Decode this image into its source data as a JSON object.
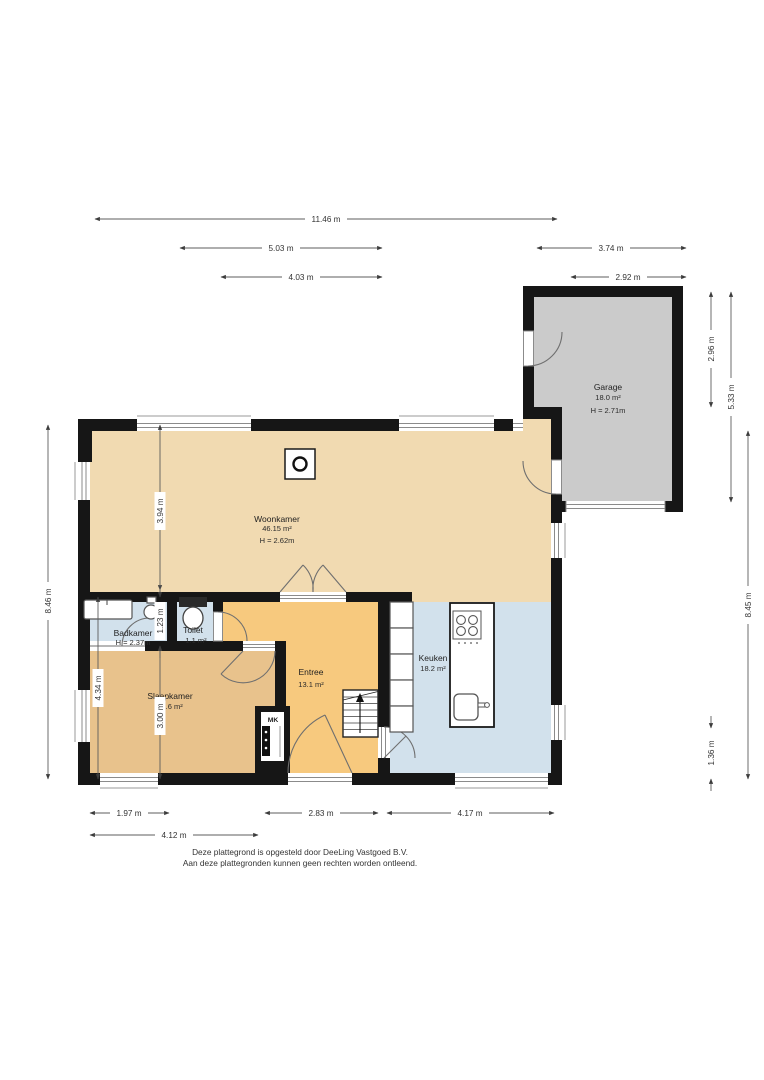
{
  "rooms": {
    "woonkamer": {
      "name": "Woonkamer",
      "area": "46.15 m²",
      "height": "H = 2.62m"
    },
    "garage": {
      "name": "Garage",
      "area": "18.0 m²",
      "height": "H = 2.71m"
    },
    "badkamer": {
      "name": "Badkamer",
      "height": "H = 2.37m"
    },
    "toilet": {
      "name": "Toilet",
      "area": "1.1 m²"
    },
    "slaapkamer": {
      "name": "Slaapkamer",
      "area": "12.6 m²"
    },
    "entree": {
      "name": "Entree",
      "area": "13.1 m²"
    },
    "keuken": {
      "name": "Keuken",
      "area": "18.2 m²"
    },
    "meterkast": {
      "label": "MK"
    }
  },
  "dims": {
    "top_total": "11.46 m",
    "top_left_mid": "5.03 m",
    "top_right_mid": "3.74 m",
    "top_left_inner": "4.03 m",
    "top_right_inner": "2.92 m",
    "left_total": "8.46 m",
    "left_lower_mid": "4.34 m",
    "left_upper": "3.94 m",
    "left_strip": "1.23 m",
    "left_bottom": "3.00 m",
    "right_garage_upper": "2.96 m",
    "right_garage": "5.33 m",
    "right_total": "8.45 m",
    "right_lower": "1.36 m",
    "bottom_slaapkamer": "1.97 m",
    "bottom_entree": "2.83 m",
    "bottom_keuken": "4.17 m",
    "bottom_left_total": "4.12 m"
  },
  "footer": {
    "line1": "Deze plattegrond is opgesteld door DeeLing Vastgoed B.V.",
    "line2": "Aan deze plattegronden kunnen geen rechten worden ontleend."
  },
  "colors": {
    "wall": "#161616",
    "woonkamer": "#f1dab1",
    "entree": "#f7c97e",
    "slaapkamer": "#e8c28c",
    "wet_rooms": "#d2e1ec",
    "garage": "#cbcbcb"
  }
}
